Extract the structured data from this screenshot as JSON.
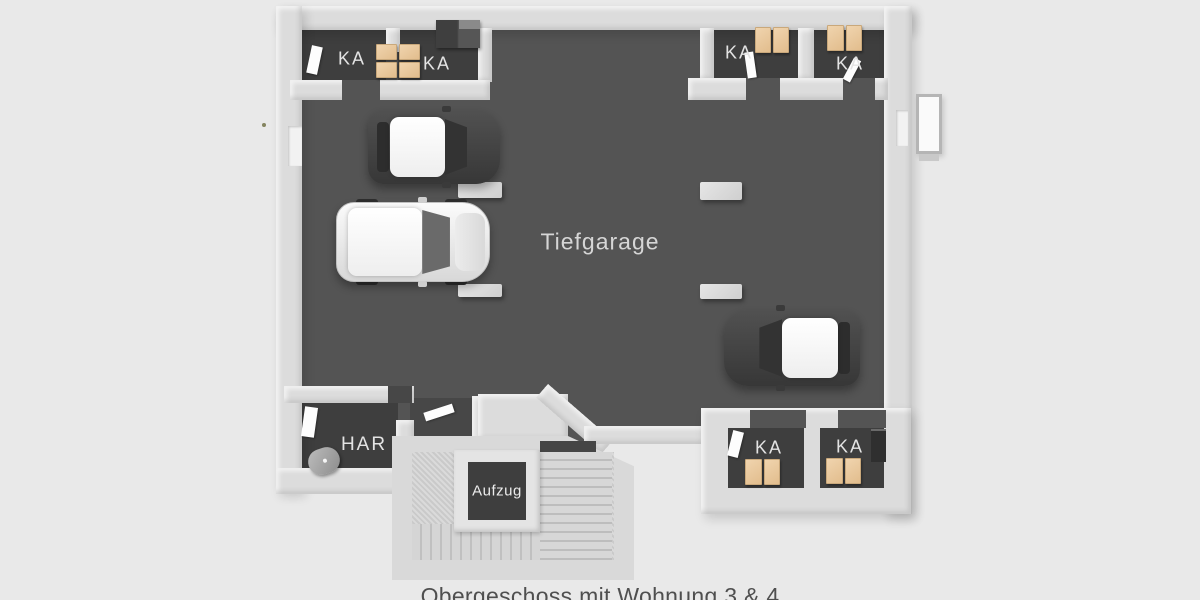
{
  "scene": {
    "description": "3D top-view floor plan of an underground parking level",
    "caption": "Obergeschoss mit Wohnung 3 & 4"
  },
  "rooms": {
    "garage": {
      "label": "Tiefgarage"
    },
    "technical_room": {
      "label": "HAR"
    },
    "elevator": {
      "label": "Aufzug"
    },
    "storage_units": [
      {
        "label": "KA"
      },
      {
        "label": "KA"
      },
      {
        "label": "KA"
      },
      {
        "label": "KA"
      },
      {
        "label": "KA"
      },
      {
        "label": "KA"
      }
    ]
  },
  "objects": {
    "cars": 3,
    "parking_dividers": 4,
    "storage_box_stacks": 5,
    "staircase": true,
    "tank_cylinder": true
  },
  "colors": {
    "background": "#e9e9e9",
    "wall": "#dcdcdc",
    "garage_floor": "#545454",
    "storage_floor": "#3e3e3e",
    "stair_floor": "#d0d0d0",
    "box": "#eac9a2",
    "room_label": "#e3e3e3",
    "caption_text": "#4f4f4f"
  }
}
